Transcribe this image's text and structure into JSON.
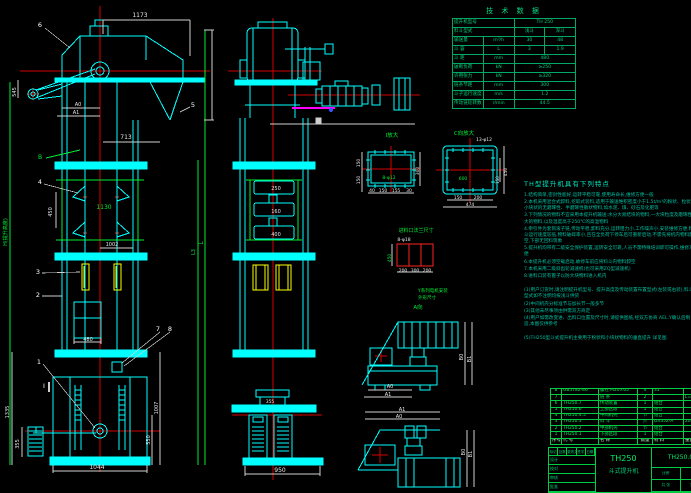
{
  "drawing": {
    "balloons": {
      "b1": "1",
      "b2": "2",
      "b3": "3",
      "b4": "4",
      "b5": "5",
      "b6": "6",
      "b7": "7",
      "b8": "8",
      "bB": "B",
      "bI": "I",
      "section_a": "A向"
    },
    "front": {
      "dim_top": "1173",
      "dim_mid": "713",
      "dim_green": "1130",
      "dim_pitch": "450",
      "dim_1002": "1002",
      "dim_door": "480",
      "dim_left_head": "545",
      "dim_a0": "A0",
      "dim_a1": "A1",
      "dim_boot_h1": "1335",
      "dim_boot_h2": "355",
      "dim_boot_r1": "1007",
      "dim_boot_r2": "550",
      "dim_base": "1044",
      "dim_L": "L",
      "dim_L3": "L3",
      "height_label": "H(提升高度)"
    },
    "side": {
      "dim_250": "250",
      "dim_160": "160",
      "dim_400": "400",
      "dim_boot_top": "355",
      "dim_base": "950"
    },
    "detail_i": {
      "title": "I放大",
      "bolts": "8-φ12",
      "d150a": "150",
      "d150b": "150",
      "d300": "300",
      "b1": "40",
      "b2": "150",
      "b3": "155",
      "b4": "30"
    },
    "detail_c": {
      "title": "C向放大",
      "bolts": "13-φ12",
      "center": "600",
      "r450": "450",
      "r150": "150",
      "b150": "150",
      "b200": "200",
      "total": "474"
    },
    "inlet": {
      "title": "进料口法兰尺寸",
      "bolts": "8-φ18",
      "h": "450",
      "b1": "200",
      "b2": "300",
      "b3": "200"
    },
    "motor_note": {
      "line1": "Y系列电机安装",
      "line2": "外形尺寸"
    },
    "drive1": {
      "a0": "A0",
      "a1": "A1",
      "b0": "B0",
      "b1": "B1"
    },
    "drive2": {
      "a0": "A0",
      "a1": "A1",
      "b0": "B0",
      "b1": "B1"
    }
  },
  "tech_table": {
    "title": "技 术 数 据",
    "r1_label": "提升机型号",
    "r1_value": "TH 250",
    "r2_label": "料斗型式",
    "r2_v1": "浅斗",
    "r2_v2": "深斗",
    "r3_label": "输送量",
    "r3_unit": "m³/h",
    "r3_v1": "30",
    "r3_v2": "48",
    "g1": "料斗",
    "r4_label": "斗 容",
    "r4_unit": "L",
    "r4_v1": "3",
    "r4_v2": "1.9",
    "r5_label": "斗 距",
    "r5_unit": "mm",
    "r5_value": "480",
    "g2": "链条",
    "r6_label": "破断负荷",
    "r6_unit": "kN",
    "r6_value": "≥250",
    "r7_label": "许用张力",
    "r7_unit": "kN",
    "r7_value": "≥320",
    "r8_label": "链条节距",
    "r8_unit": "mm",
    "r8_value": "300",
    "r9_label": "斗子运行速度",
    "r9_unit": "m/s",
    "r9_value": "1.2",
    "r10_label": "传动链轮转数",
    "r10_unit": "r/min",
    "r10_value": "44.5"
  },
  "notes": {
    "title": "TH型提升机具有下列特点",
    "lines": [
      "1.结构简单,密封性能好,运转平稳可靠,使用寿命长,维修方便一般",
      "2.本机采用混合式卸料,挖取式装料,适用于输送堆积密度小于1.5t/m³的粉状、粒状及小块状的无磨琢性、半磨琢性散状物料,如水泥、煤、砂石及化肥等",
      "3.下列情况的物料不宜采用本提升机输送:水分大易结块的物料,一大块粒度及磨琢性大的物料,以及温度高于250℃的高温物料",
      "4.牵引件为套筒滚子链,传动平稳,卸料充分,运转阻力小,工作噪声小,安装维修方便,料斗运行速度较低,物料破碎率小,且在全负荷下停车后可重新启动,不需先将机内物料卸空,下部无回料现象",
      "5.提升机均带有二级安全保护装置,运转安全可靠,人员不需特殊培训即可操作,维修方便",
      "6.本提升机必须空载启动,故停车前应将料斗内物料卸空",
      "7.本机采用二级斜齿轮减速机(也可采用ZQ型减速机)",
      "8.进料口装有篦子以防大块物料进入机内",
      "",
      "(1)用户订货时,请注明提升机型号、提升高度及传动装置布置型式(左装或右装),料斗型式如不注明均按浅斗供货",
      "(2)中间机壳分标准节与加长节一般多节",
      "(3)其他未尽事项由供需双方商定",
      "(4)用户如需改变进、出料口位置及尺寸时,请提供图纸,经双方协商 AEL.Y确认后制造,本图仅供参考",
      "",
      "(5)TH250型斗式提升机主要用于粉状和小块状物料的垂直提升 详见图."
    ]
  },
  "parts_list": {
    "headers": [
      "序号",
      "代 号",
      "名 称",
      "数量",
      "材 料",
      "重量",
      "备注"
    ],
    "rows": [
      [
        "8",
        "GB5782-86",
        "螺栓 M20×65",
        "4",
        "35",
        "",
        ""
      ],
      [
        "7",
        "",
        "链 条",
        "2",
        "",
        "L=",
        ""
      ],
      [
        "6",
        "TH250.7",
        "传动装置",
        "1",
        "组合",
        "",
        ""
      ],
      [
        "5",
        "TH250.6",
        "上部区段",
        "1",
        "组合",
        "",
        ""
      ],
      [
        "4",
        "TH250.4.5",
        "中间机壳",
        "节",
        "组合",
        "",
        ""
      ],
      [
        "3",
        "TH250.3",
        "料 斗",
        "只",
        "DX35Z-A",
        "204",
        ""
      ],
      [
        "2",
        "TH250.2",
        "中部机壳",
        "节",
        "组合",
        "",
        ""
      ],
      [
        "1",
        "TH250.1",
        "下部区段",
        "1",
        "组合",
        "",
        ""
      ]
    ]
  },
  "title_block": {
    "model": "TH250",
    "product": "斗式提升机",
    "drawing_no": "TH250.0",
    "rev_labels": [
      "标记",
      "处数",
      "更改文件号",
      "签字",
      "日期"
    ],
    "sign_labels": [
      "设计",
      "校对",
      "审核",
      "批准"
    ],
    "info_labels": [
      "比例",
      "数量",
      "共 张",
      "第 张"
    ]
  }
}
